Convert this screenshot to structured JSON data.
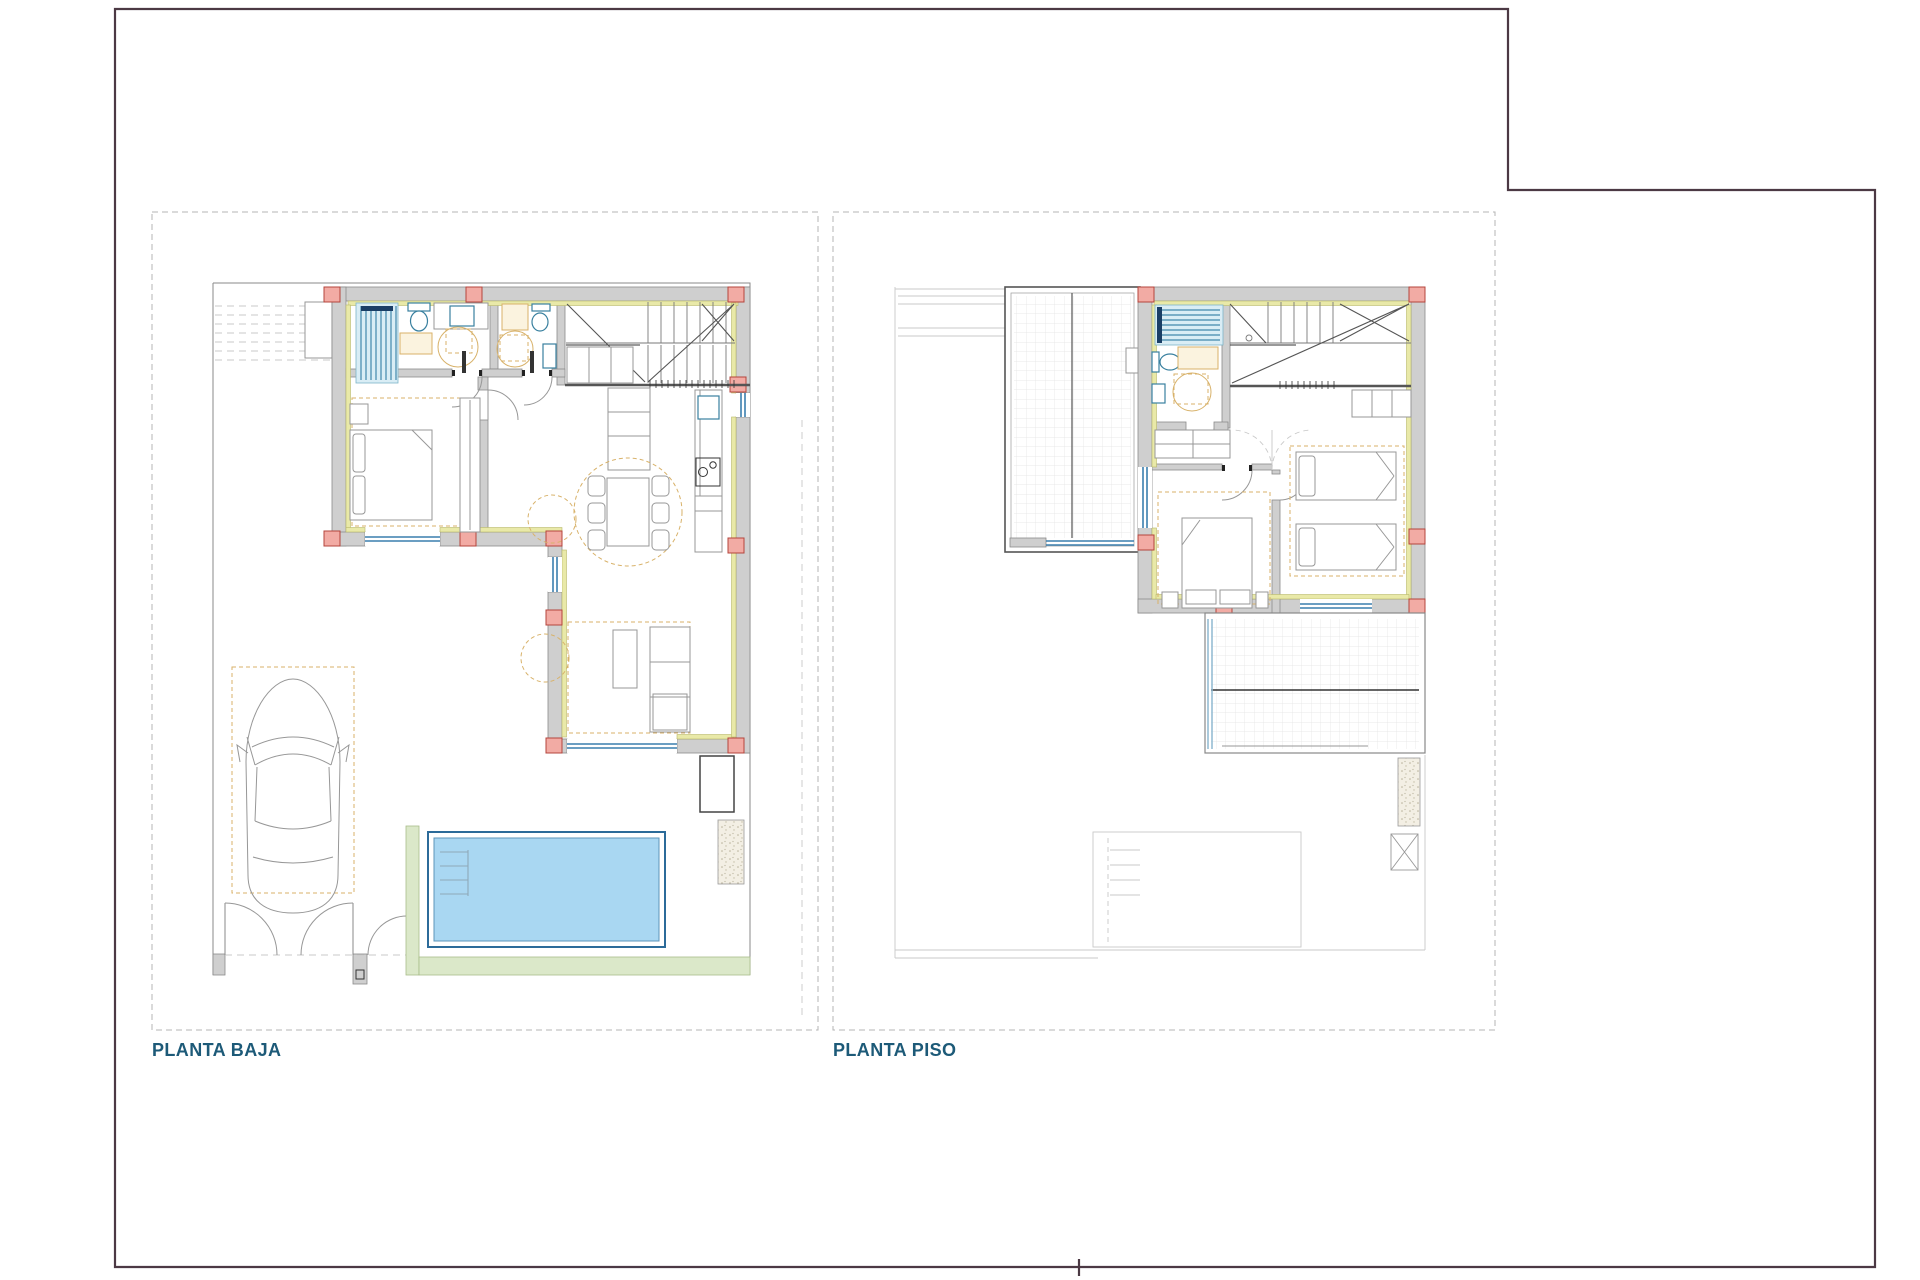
{
  "sheet": {
    "width": 1920,
    "height": 1280,
    "background": "#ffffff"
  },
  "plans": [
    {
      "id": "planta-baja",
      "label": "PLANTA BAJA"
    },
    {
      "id": "planta-piso",
      "label": "PLANTA PISO"
    }
  ],
  "palette": {
    "sheet_bg": "#ffffff",
    "border_color": "#4c3944",
    "panel_border": "#b4b4b4",
    "label_color": "#1d5a78",
    "wall_fill": "#cfcfcf",
    "wall_stroke": "#8a8a8a",
    "insulation": "#e9e9a8",
    "insulation_stroke": "#b9b96a",
    "column_fill": "#f2aba4",
    "column_stroke": "#b4453c",
    "window_blue": "#3a7fae",
    "fixture_teal": "#39809f",
    "shower_fill": "#d9edf5",
    "shower_stripe": "#4188ac",
    "navy": "#1a3f66",
    "pool_fill": "#a9d7f2",
    "pool_stroke": "#2c6b99",
    "green_fill": "#dbe8c9",
    "green_stroke": "#a9bd8a",
    "furniture_tan": "#d8b26a",
    "furniture_gray": "#979797",
    "ghost": "#c9c9c9",
    "grid": "#e3e3e3",
    "stair": "#7a7a7a",
    "dark": "#333333"
  }
}
